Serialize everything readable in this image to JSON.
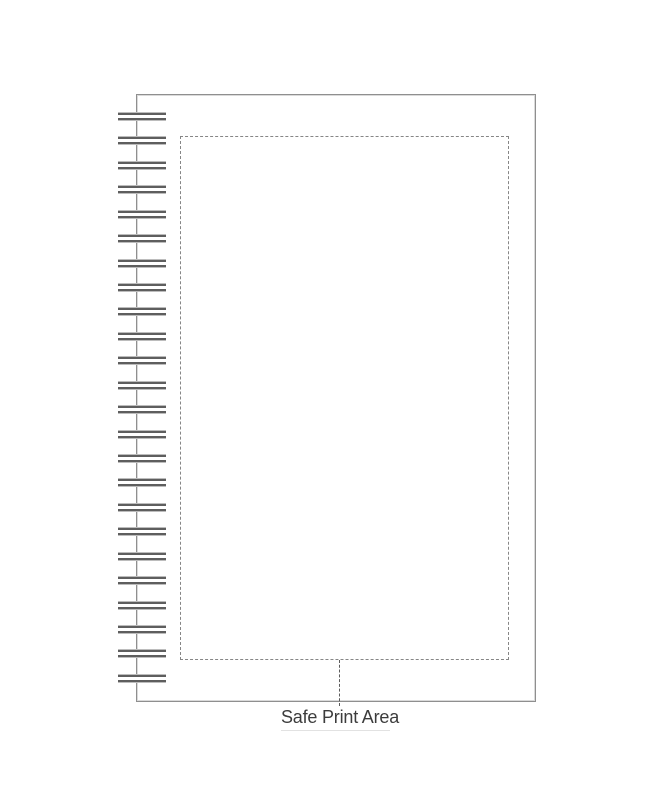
{
  "template": {
    "label": "Safe Print Area"
  },
  "spiral": {
    "coil_count": 24,
    "first_coil_top": 113,
    "coil_spacing": 24.43
  },
  "colors": {
    "background": "#ffffff",
    "page_border": "#8f8f8f",
    "page_border_inner": "#dadada",
    "dash": "#868686",
    "leader_dash": "#5c5c5c",
    "coil_dark": "#5e5e5e",
    "coil_light": "#bcbcbc",
    "label_text": "#3c3c3c",
    "underline": "#e2e2e2"
  }
}
